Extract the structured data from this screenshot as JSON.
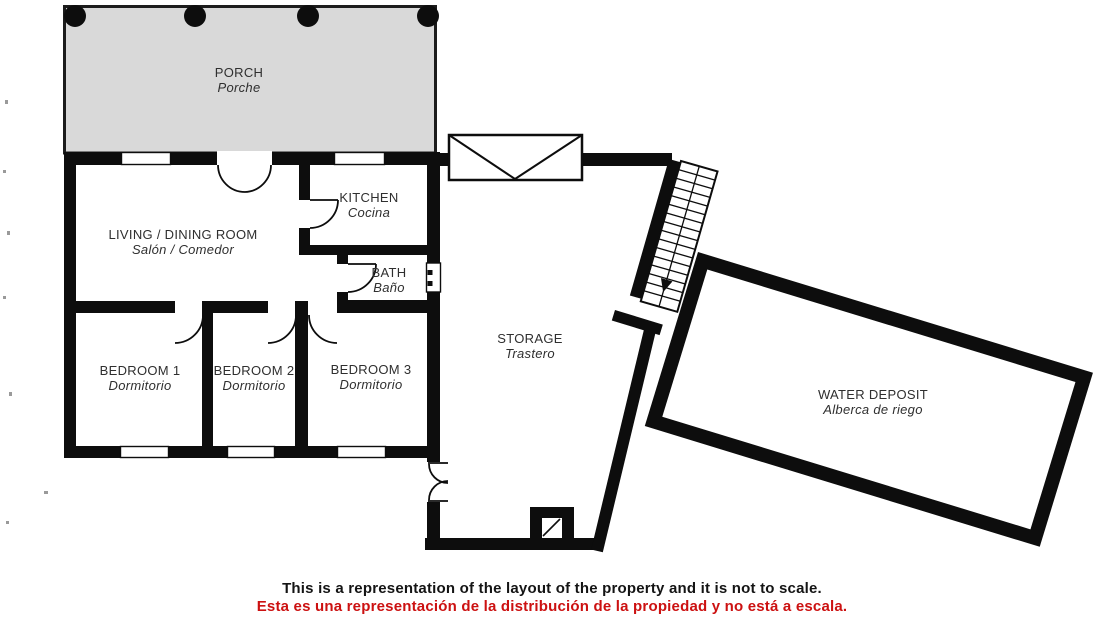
{
  "plan": {
    "title": "Property floor plan",
    "rooms": [
      {
        "id": "porch",
        "label": "PORCH",
        "sublabel": "Porche"
      },
      {
        "id": "living-dining",
        "label": "LIVING / DINING ROOM",
        "sublabel": "Salón / Comedor"
      },
      {
        "id": "kitchen",
        "label": "KITCHEN",
        "sublabel": "Cocina"
      },
      {
        "id": "bath",
        "label": "BATH",
        "sublabel": "Baño"
      },
      {
        "id": "bedroom-1",
        "label": "BEDROOM 1",
        "sublabel": "Dormitorio"
      },
      {
        "id": "bedroom-2",
        "label": "BEDROOM 2",
        "sublabel": "Dormitorio"
      },
      {
        "id": "bedroom-3",
        "label": "BEDROOM 3",
        "sublabel": "Dormitorio"
      },
      {
        "id": "storage",
        "label": "STORAGE",
        "sublabel": "Trastero"
      },
      {
        "id": "water-deposit",
        "label": "WATER DEPOSIT",
        "sublabel": "Alberca de riego"
      }
    ],
    "disclaimer": {
      "en": "This is a representation of the layout of the property and it is not to scale.",
      "es": "Esta es una representación de la distribución de la propiedad y no está a escala."
    },
    "symbols": [
      "porch-column",
      "window",
      "door-swing-arc",
      "double-door",
      "gate-symbol",
      "staircase",
      "stair-direction-arrow",
      "manhole"
    ],
    "colors": {
      "wall": "#0d0d0d",
      "porch_fill": "#d9d9d9",
      "label_text": "#2f2f2f",
      "disclaimer_en": "#141414",
      "disclaimer_es": "#cc1111",
      "background": "#ffffff"
    }
  }
}
